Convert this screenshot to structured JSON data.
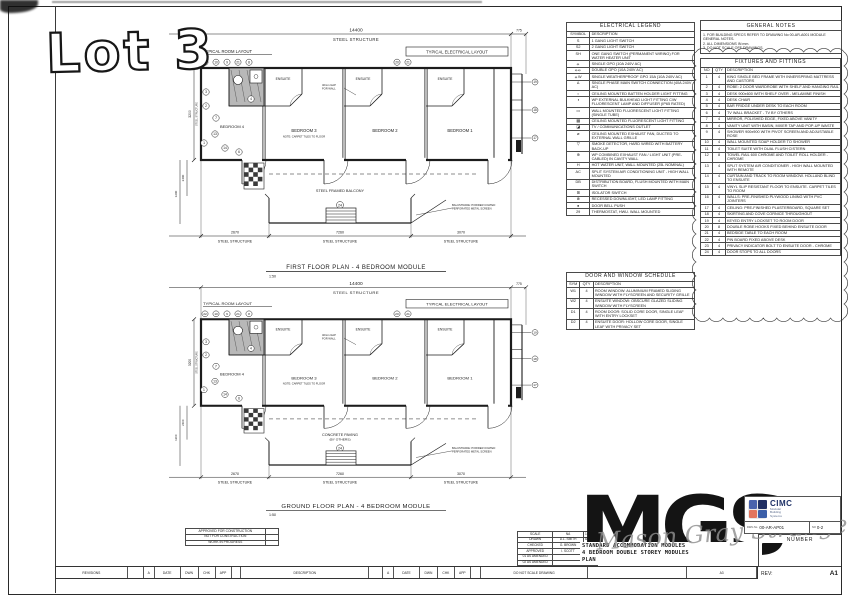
{
  "sheet": {
    "lot_stamp": "Lot 3",
    "paper_size": "A3"
  },
  "colors": {
    "ink": "#1c1c1c",
    "cimc_navy": "#1d3066",
    "cimc_blue_tl": "#4a63ad",
    "cimc_blue_tr": "#202f63",
    "cimc_red_bl": "#e2755e",
    "cimc_blue_br": "#3c5fa8",
    "watermark_gray": "#8f8f8f"
  },
  "plans": [
    {
      "title": "FIRST FLOOR PLAN - 4 BEDROOM MODULE",
      "scale": "1:50",
      "dim_top": "14400",
      "dim_top_right": "775",
      "steel_structure": "STEEL STRUCTURE",
      "typical_room_layout": "TYPICAL ROOM LAYOUT",
      "typical_electrical_layout": "TYPICAL ELECTRICAL LAYOUT",
      "rooms": [
        "BEDROOM 4",
        "BEDROOM 3",
        "BEDROOM 2",
        "BEDROOM 1"
      ],
      "ensuite": "ENSUITE",
      "room_note": "NOTE: CARPET TILES TO FLOOR",
      "gap_note": [
        "40mm GAP",
        "FOR WALL"
      ],
      "deck_label": [
        "STEEL FRAMED BALCONY",
        ""
      ],
      "deck_circle": "24",
      "balustrade_note": [
        "BALUSTRADE: POWDER COATED",
        "PERFORATED METAL SCREEN"
      ],
      "bottom_dims": [
        "2670",
        "7260",
        "3070"
      ],
      "bottom_labels": [
        "STEEL STRUCTURE",
        "STEEL STRUCTURE",
        "STEEL STRUCTURE"
      ],
      "left_dims": [
        "3200",
        "2400",
        "1200"
      ],
      "top_circles": [
        "22",
        "10",
        "9",
        "21",
        "8"
      ],
      "mid_circles": [
        "20",
        "21"
      ],
      "right_circles": [
        "19",
        "18",
        "17"
      ],
      "room_circles": [
        [
          "3",
          52,
          70
        ],
        [
          "2",
          52,
          84
        ],
        [
          "7",
          62,
          96
        ],
        [
          "1",
          50,
          121
        ],
        [
          "14",
          71,
          126
        ],
        [
          "6",
          85,
          130
        ],
        [
          "4",
          97,
          77
        ],
        [
          "13",
          61,
          112
        ]
      ]
    },
    {
      "title": "GROUND FLOOR PLAN - 4 BEDROOM MODULE",
      "scale": "1:50",
      "dim_top": "14400",
      "dim_top_right": "775",
      "steel_structure": "STEEL STRUCTURE",
      "typical_room_layout": "TYPICAL ROOM LAYOUT",
      "typical_electrical_layout": "TYPICAL ELECTRICAL LAYOUT",
      "rooms": [
        "BEDROOM 4",
        "BEDROOM 3",
        "BEDROOM 2",
        "BEDROOM 1"
      ],
      "ensuite": "ENSUITE",
      "room_note": "NOTE: CARPET TILES TO FLOOR",
      "gap_note": [
        "40mm GAP",
        "FOR WALL"
      ],
      "deck_label": [
        "CONCRETE PAVING",
        "(BY OTHERS)"
      ],
      "deck_circle": "24",
      "balustrade_note": [
        "BALUSTRADE: POWDER COATED",
        "PERFORATED METAL SCREEN"
      ],
      "bottom_dims": [
        "2670",
        "7260",
        "3070"
      ],
      "bottom_labels": [
        "STEEL STRUCTURE",
        "STEEL STRUCTURE",
        "STEEL STRUCTURE"
      ],
      "left_dims": [
        "3200",
        "2400",
        "1200"
      ],
      "top_circles": [
        "22",
        "10",
        "9",
        "21",
        "8"
      ],
      "mid_circles": [
        "20",
        "21"
      ],
      "right_circles": [
        "19",
        "18",
        "17"
      ],
      "room_circles": [
        [
          "3",
          52,
          70
        ],
        [
          "2",
          52,
          84
        ],
        [
          "7",
          62,
          96
        ],
        [
          "1",
          50,
          121
        ],
        [
          "14",
          71,
          126
        ],
        [
          "6",
          85,
          130
        ],
        [
          "4",
          97,
          77
        ],
        [
          "13",
          61,
          112
        ]
      ]
    }
  ],
  "electrical_legend": {
    "title": "ELECTRICAL LEGEND",
    "col_symbol": "SYMBOL",
    "col_description": "DESCRIPTION",
    "rows": [
      {
        "sym": "S",
        "desc": "1 GANG LIGHT SWITCH"
      },
      {
        "sym": "S2",
        "desc": "2 GANG LIGHT SWITCH"
      },
      {
        "sym": "SH",
        "desc": "ONE GANG SWITCH (PERMANENT WIRING) FOR WATER HEATER UNIT"
      },
      {
        "sym": "⦵",
        "desc": "SINGLE GPO (10A 240V AC)"
      },
      {
        "sym": "⦵⦵",
        "desc": "DOUBLE GPO (10A 240V AC)"
      },
      {
        "sym": "⦵W",
        "desc": "SINGLE WEATHERPROOF GPO 15A (10A 240V AC)"
      },
      {
        "sym": "Δ",
        "desc": "SINGLE PHASE MAIN SWITCH CONNECTION (40A 240V AC)"
      },
      {
        "sym": "○",
        "desc": "CEILING MOUNTED BATTEN HOLDER LIGHT FITTING"
      },
      {
        "sym": "◑",
        "desc": "WP EXTERNAL BULKHEAD LIGHT FITTING C/W FLUORESCENT LAMP AND DIFFUSER (IP65 RATED)"
      },
      {
        "sym": "▭",
        "desc": "WALL MOUNTED FLUORESCENT LIGHT FITTING (SINGLE TUBE)"
      },
      {
        "sym": "▦",
        "desc": "CEILING MOUNTED FLUORESCENT LIGHT FITTING"
      },
      {
        "sym": "◪",
        "desc": "TV / COMMUNICATIONS OUTLET"
      },
      {
        "sym": "⌀",
        "desc": "CEILING MOUNTED EXHAUST FAN, DUCTED TO EXTERNAL WALL GRILLE"
      },
      {
        "sym": "▽",
        "desc": "SMOKE DETECTOR, HARD WIRED WITH BATTERY BACK-UP"
      },
      {
        "sym": "⊕",
        "desc": "WP COMBINED EXHAUST FAN / LIGHT UNIT (PRE-CABLED) IN CAVITY WALL"
      },
      {
        "sym": "H",
        "desc": "HOT WATER UNIT, WALL MOUNTED (25L NOMINAL)"
      },
      {
        "sym": "AC",
        "desc": "SPLIT SYSTEM AIR CONDITIONING UNIT - HIGH WALL MOUNTED"
      },
      {
        "sym": "DB",
        "desc": "DISTRIBUTION BOARD, FLUSH MOUNTED WITH MAIN SWITCH"
      },
      {
        "sym": "⊞",
        "desc": "ISOLATOR SWITCH"
      },
      {
        "sym": "⊗",
        "desc": "RECESSED DOWNLIGHT, LED LAMP FITTING"
      },
      {
        "sym": "●",
        "desc": "DOOR BELL PUSH"
      },
      {
        "sym": "29",
        "desc": "THERMOSTAT, HWU. WALL MOUNTED"
      }
    ]
  },
  "door_window_schedule": {
    "title": "DOOR AND WINDOW SCHEDULE",
    "col_sym": "SYM",
    "col_qty": "QTY",
    "col_description": "DESCRIPTION",
    "rows": [
      {
        "sym": "W1",
        "qty": "4",
        "desc": "ROOM WINDOW: ALUMINIUM FRAMED SLIDING WINDOW WITH FLYSCREEN AND SECURITY GRILLE"
      },
      {
        "sym": "W2",
        "qty": "4",
        "desc": "ENSUITE WINDOW: OBSCURE GLAZED SLIDING WINDOW WITH FLYSCREEN"
      },
      {
        "sym": "D1",
        "qty": "4",
        "desc": "ROOM DOOR: SOLID CORE DOOR, SINGLE LEAF WITH ENTRY LOCKSET"
      },
      {
        "sym": "D2",
        "qty": "4",
        "desc": "ENSUITE DOOR: HOLLOW CORE DOOR, SINGLE LEAF WITH PRIVACY SET"
      }
    ]
  },
  "general_notes": {
    "title": "GENERAL NOTES",
    "lines": [
      "1. FOR BUILDING SPECS REFER TO DRAWING No 00-AR-A001 MODULE GENERAL NOTES.",
      "2. ALL DIMENSIONS IN mm.",
      "3. DO NOT SCALE OFF DRAWINGS."
    ]
  },
  "fixtures": {
    "title": "FIXTURES AND FITTINGS",
    "col_no": "NO",
    "col_qty": "QTY",
    "col_description": "DESCRIPTION",
    "rows": [
      {
        "no": "1",
        "qty": "4",
        "desc": "KING SINGLE BED FRAME WITH INNERSPRING MATTRESS AND CASTORS"
      },
      {
        "no": "2",
        "qty": "4",
        "desc": "ROBE: 2 DOOR WARDROBE WITH SHELF AND HANGING RAIL"
      },
      {
        "no": "3",
        "qty": "4",
        "desc": "DESK 900x600 WITH SHELF OVER - MELAMINE FINISH"
      },
      {
        "no": "4",
        "qty": "4",
        "desc": "DESK CHAIR"
      },
      {
        "no": "5",
        "qty": "4",
        "desc": "BAR FRIDGE UNDER DESK TO EACH ROOM"
      },
      {
        "no": "6",
        "qty": "4",
        "desc": "TV WALL BRACKET - TV BY OTHERS"
      },
      {
        "no": "7",
        "qty": "4",
        "desc": "MIRROR, POLISHED EDGE, FIXED ABOVE VANITY"
      },
      {
        "no": "8",
        "qty": "4",
        "desc": "VANITY UNIT WITH BASIN, MIXER TAP AND POP-UP WASTE"
      },
      {
        "no": "9",
        "qty": "4",
        "desc": "SHOWER 900x900 WITH PIVOT SCREEN AND ADJUSTABLE ROSE"
      },
      {
        "no": "10",
        "qty": "4",
        "desc": "WALL MOUNTED SOAP HOLDER TO SHOWER"
      },
      {
        "no": "11",
        "qty": "4",
        "desc": "TOILET SUITE WITH DUAL FLUSH CISTERN"
      },
      {
        "no": "12",
        "qty": "8",
        "desc": "TOWEL RAIL 600 CHROME AND TOILET ROLL HOLDER - CHROME"
      },
      {
        "no": "13",
        "qty": "4",
        "desc": "SPLIT SYSTEM AIR CONDITIONER - HIGH WALL MOUNTED WITH REMOTE"
      },
      {
        "no": "14",
        "qty": "4",
        "desc": "CURTAIN AND TRACK TO ROOM WINDOW. HOLLAND BLIND TO ENSUITE"
      },
      {
        "no": "15",
        "qty": "4",
        "desc": "VINYL SLIP RESISTANT FLOOR TO ENSUITE. CARPET TILES TO ROOM"
      },
      {
        "no": "16",
        "qty": "4",
        "desc": "WALLS: PRE-FINISHED PLYWOOD LINING WITH PVC JOINTERS"
      },
      {
        "no": "17",
        "qty": "4",
        "desc": "CEILING: PRE-FINISHED PLASTERBOARD, SQUARE SET"
      },
      {
        "no": "18",
        "qty": "4",
        "desc": "SKIRTING AND COVE CORNICE THROUGHOUT"
      },
      {
        "no": "19",
        "qty": "4",
        "desc": "KEYED ENTRY LOCKSET TO ROOM DOOR"
      },
      {
        "no": "20",
        "qty": "8",
        "desc": "DOUBLE ROBE HOOKS FIXED BEHIND ENSUITE DOOR"
      },
      {
        "no": "21",
        "qty": "4",
        "desc": "BEDSIDE TABLE TO EACH ROOM"
      },
      {
        "no": "22",
        "qty": "4",
        "desc": "PIN BOARD FIXED ABOVE DESK"
      },
      {
        "no": "23",
        "qty": "4",
        "desc": "PRIVACY INDICATOR BOLT TO ENSUITE DOOR - CHROME"
      },
      {
        "no": "24",
        "qty": "4",
        "desc": "DOOR STOPS TO ALL DOORS"
      }
    ]
  },
  "title_block": {
    "company": "CIMC",
    "company_sub": [
      "Modular",
      "Building",
      "Systems"
    ],
    "dwg_no_label": "DWG No",
    "dwg_no": "00-AR-AP01",
    "sheet_no_label": "NO",
    "sheet_no": "0-2",
    "number_label": "NUMBER",
    "rev_label": "REV:",
    "rev_value": "A1",
    "title_lines": [
      "STANDARD ACCOMMODATION MODULES",
      "4 BEDROOM DOUBLE STOREY MODULES",
      "PLAN"
    ],
    "approvals": [
      "APPROVED FOR CONSTRUCTION",
      "NOT FOR CONSTRUCTION",
      "WORK IN PROGRESS"
    ],
    "info_rows": [
      [
        "SCALE",
        "NA",
        "1:50"
      ],
      [
        "DRAWN",
        "D.L. SMITH",
        "8/5/13"
      ],
      [
        "CHECKED",
        "G. BROWN",
        "8/5/13"
      ],
      [
        "APPROVED",
        "I. SCOTT",
        "8/5/13"
      ],
      [
        "01 AS AMENDED",
        "",
        ""
      ],
      [
        "02 AS AMENDED",
        "",
        ""
      ],
      [
        "03 AS AMENDED",
        "",
        ""
      ]
    ],
    "strip_cells": [
      {
        "t": "REVISIONS",
        "w": 72
      },
      {
        "t": "",
        "w": 16
      },
      {
        "t": "A",
        "w": 11
      },
      {
        "t": "DATE",
        "w": 26
      },
      {
        "t": "DWN",
        "w": 18
      },
      {
        "t": "CHK",
        "w": 17
      },
      {
        "t": "APP",
        "w": 16
      },
      {
        "t": "",
        "w": 10
      },
      {
        "t": "DESCRIPTION",
        "w": 128
      },
      {
        "t": "",
        "w": 14
      },
      {
        "t": "A",
        "w": 11
      },
      {
        "t": "DATE",
        "w": 26
      },
      {
        "t": "DWN",
        "w": 18
      },
      {
        "t": "CHK",
        "w": 17
      },
      {
        "t": "APP",
        "w": 16
      },
      {
        "t": "",
        "w": 10
      },
      {
        "t": "DO NOT SCALE DRAWING",
        "w": 108
      },
      {
        "t": "",
        "w": 99
      },
      {
        "t": "A3",
        "w": 70
      }
    ]
  },
  "watermark": {
    "big": "MGS",
    "script": "Mason Gray Strange"
  }
}
